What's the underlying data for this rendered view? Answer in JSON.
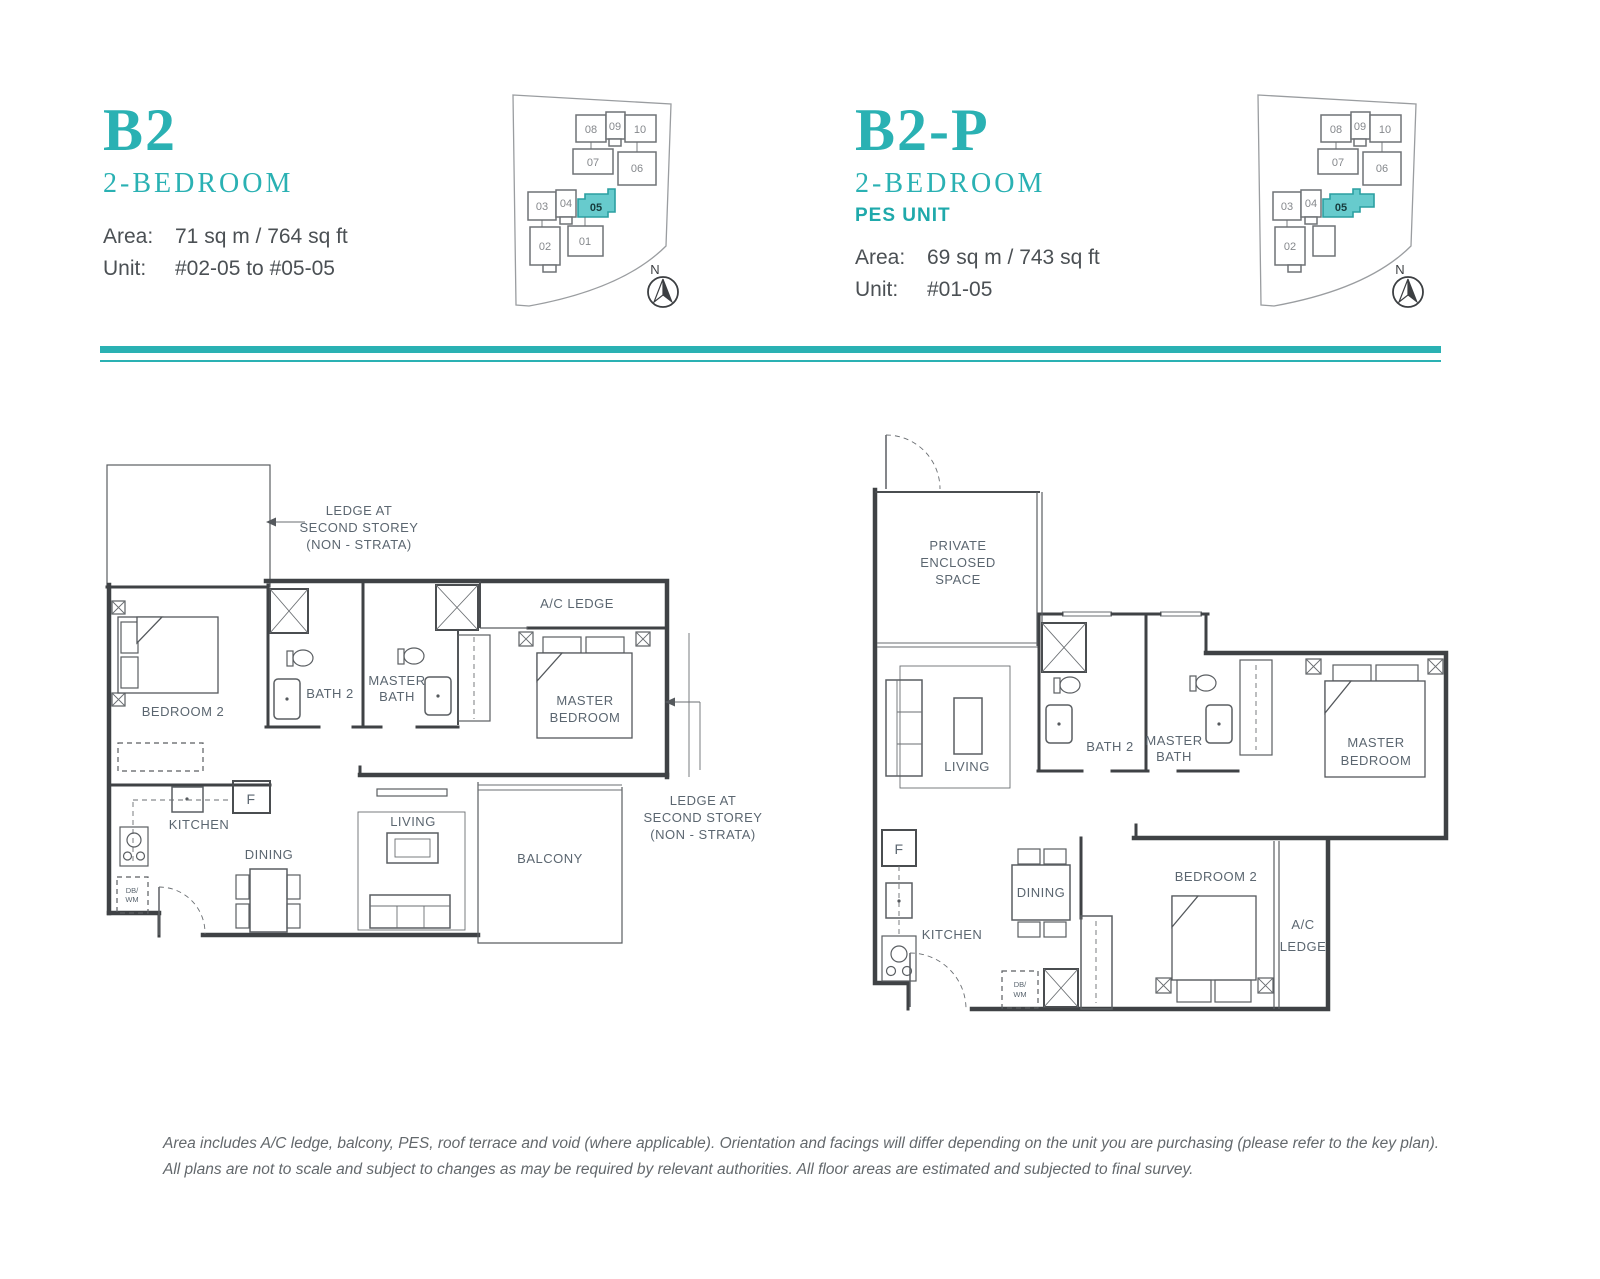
{
  "accent": "#2ab1b3",
  "highlight_fill": "#67cbcd",
  "left_unit": {
    "code": "B2",
    "bedrooms": "2-BEDROOM",
    "area_label": "Area:",
    "area": "71 sq m / 764 sq ft",
    "unit_label": "Unit:",
    "units": "#02-05 to #05-05"
  },
  "right_unit": {
    "code": "B2-P",
    "bedrooms": "2-BEDROOM",
    "pes": "PES UNIT",
    "area_label": "Area:",
    "area": "69 sq m / 743 sq ft",
    "unit_label": "Unit:",
    "units": "#01-05"
  },
  "keyplan": {
    "north": "N",
    "u01": "01",
    "u02": "02",
    "u03": "03",
    "u04": "04",
    "u05": "05",
    "u06": "06",
    "u07": "07",
    "u08": "08",
    "u09": "09",
    "u10": "10"
  },
  "plan_b2": {
    "ledge_note": [
      "LEDGE AT",
      "SECOND  STOREY",
      "(NON - STRATA)"
    ],
    "ac_ledge": "A/C LEDGE",
    "bath2": "BATH 2",
    "master_bath": [
      "MASTER",
      "BATH"
    ],
    "master_bedroom": [
      "MASTER",
      "BEDROOM"
    ],
    "bedroom2": "BEDROOM 2",
    "kitchen": "KITCHEN",
    "dining": "DINING",
    "living": "LIVING",
    "balcony": "BALCONY",
    "fridge": "F",
    "dbwm": [
      "DB/",
      "WM"
    ]
  },
  "plan_b2p": {
    "pes": [
      "PRIVATE",
      "ENCLOSED",
      "SPACE"
    ],
    "ac_ledge": [
      "A/C",
      "LEDGE"
    ],
    "bath2": "BATH 2",
    "master_bath": [
      "MASTER",
      "BATH"
    ],
    "master_bedroom": [
      "MASTER",
      "BEDROOM"
    ],
    "bedroom2": "BEDROOM 2",
    "kitchen": "KITCHEN",
    "dining": "DINING",
    "living": "LIVING",
    "fridge": "F",
    "dbwm": [
      "DB/",
      "WM"
    ]
  },
  "footer": {
    "line1": "Area includes A/C ledge, balcony, PES, roof terrace and void (where applicable). Orientation and facings will differ depending on the unit you are purchasing (please refer to the key plan).",
    "line2": "All plans are not to scale and subject to changes as may be required by relevant authorities. All floor areas are estimated and subjected to final survey."
  }
}
